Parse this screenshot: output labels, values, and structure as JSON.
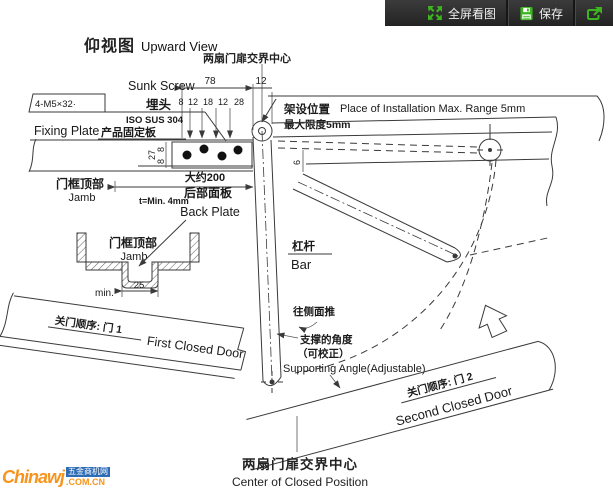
{
  "toolbar": {
    "fullscreen_label": "全屏看图",
    "save_label": "保存"
  },
  "title": {
    "cn": "仰视图",
    "en": "Upward View"
  },
  "top_center_label": "两扇门扉交界中心",
  "left_block": {
    "sunk_screw_en": "Sunk Screw",
    "sunk_screw_cn": "埋头",
    "screw_spec": "4-M5×32·",
    "material": "ISO SUS 304",
    "fixing_plate_en": "Fixing Plate",
    "fixing_plate_cn": "产品固定板"
  },
  "install": {
    "cn": "架设位置",
    "limit_cn": "最大限度5mm",
    "en": "Place of Installation Max. Range 5mm"
  },
  "dims": {
    "d78": "78",
    "d12": "12",
    "row": [
      "8",
      "12",
      "18",
      "12",
      "28"
    ],
    "d27": "27",
    "d8a": "8",
    "d8b": "8",
    "d6": "6",
    "approx200": "大约200",
    "t_min": "t=Min. 4mm",
    "d25": "25",
    "min": "min."
  },
  "jamb_top": {
    "cn": "门框顶部",
    "en": "Jamb"
  },
  "back_plate": {
    "cn": "后部面板",
    "en": "Back Plate"
  },
  "jamb_section": {
    "cn": "门框顶部",
    "en": "Jamb"
  },
  "bar": {
    "cn": "杠杆",
    "en": "Bar"
  },
  "push_label": "往侧面推",
  "support": {
    "cn1": "支撑的角度",
    "cn2": "（可校正）",
    "en": "Supporting Angle(Adjustable)"
  },
  "door1": {
    "order": "关门顺序: 门 1",
    "en": "First Closed Door"
  },
  "door2": {
    "order": "关门顺序: 门 2",
    "en": "Second Closed Door"
  },
  "bottom_label": {
    "cn": "两扇门扉交界中心",
    "en": "Center of Closed Position"
  },
  "watermark": {
    "brand": "Chinawj",
    "site": "五金商机网",
    "domain": ".COM.CN"
  },
  "colors": {
    "accent_green": "#3db51f",
    "line": "#3a3a3a",
    "toolbar_bg": "#2f2f2f",
    "watermark_orange": "#f7941d",
    "watermark_blue": "#2e6cb5"
  }
}
